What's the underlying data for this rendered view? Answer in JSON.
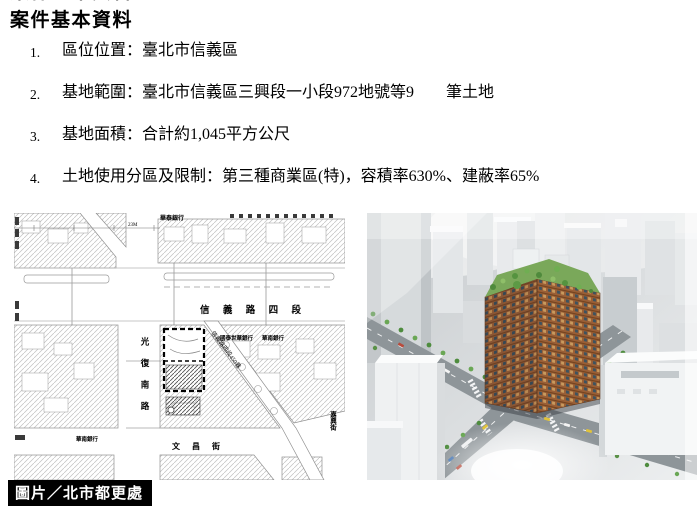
{
  "page": {
    "title": "案件基本資料",
    "caption": "圖片／北市都更處"
  },
  "list": [
    {
      "num": "1.",
      "text": "區位位置：臺北市信義區"
    },
    {
      "num": "2.",
      "text": "基地範圍：臺北市信義區三興段一小段972地號等9　　筆土地"
    },
    {
      "num": "3.",
      "text": "基地面積：合計約1,045平方公尺"
    },
    {
      "num": "4.",
      "text": "土地使用分區及限制：第三種商業區(特)，容積率630%、建蔽率65%"
    }
  ],
  "map": {
    "road_xinyi": "信 義 路 四 段",
    "road_guangfu": "光復南路",
    "road_wenchang": "文 昌 街",
    "road_lane450": "信義路四段450巷",
    "road_jiaxing": "嘉興街",
    "bank_huatai": "華泰銀行",
    "bank_cathay": "國泰世華銀行",
    "bank_huanan": "華南銀行",
    "bank_huanan_west": "華南銀行",
    "dim_label": "23M"
  },
  "colors": {
    "site_outline": "#000000",
    "building_facade": "#9a5f36",
    "roof_garden": "#79a958",
    "caption_bg": "#000000",
    "caption_text": "#ffffff"
  }
}
